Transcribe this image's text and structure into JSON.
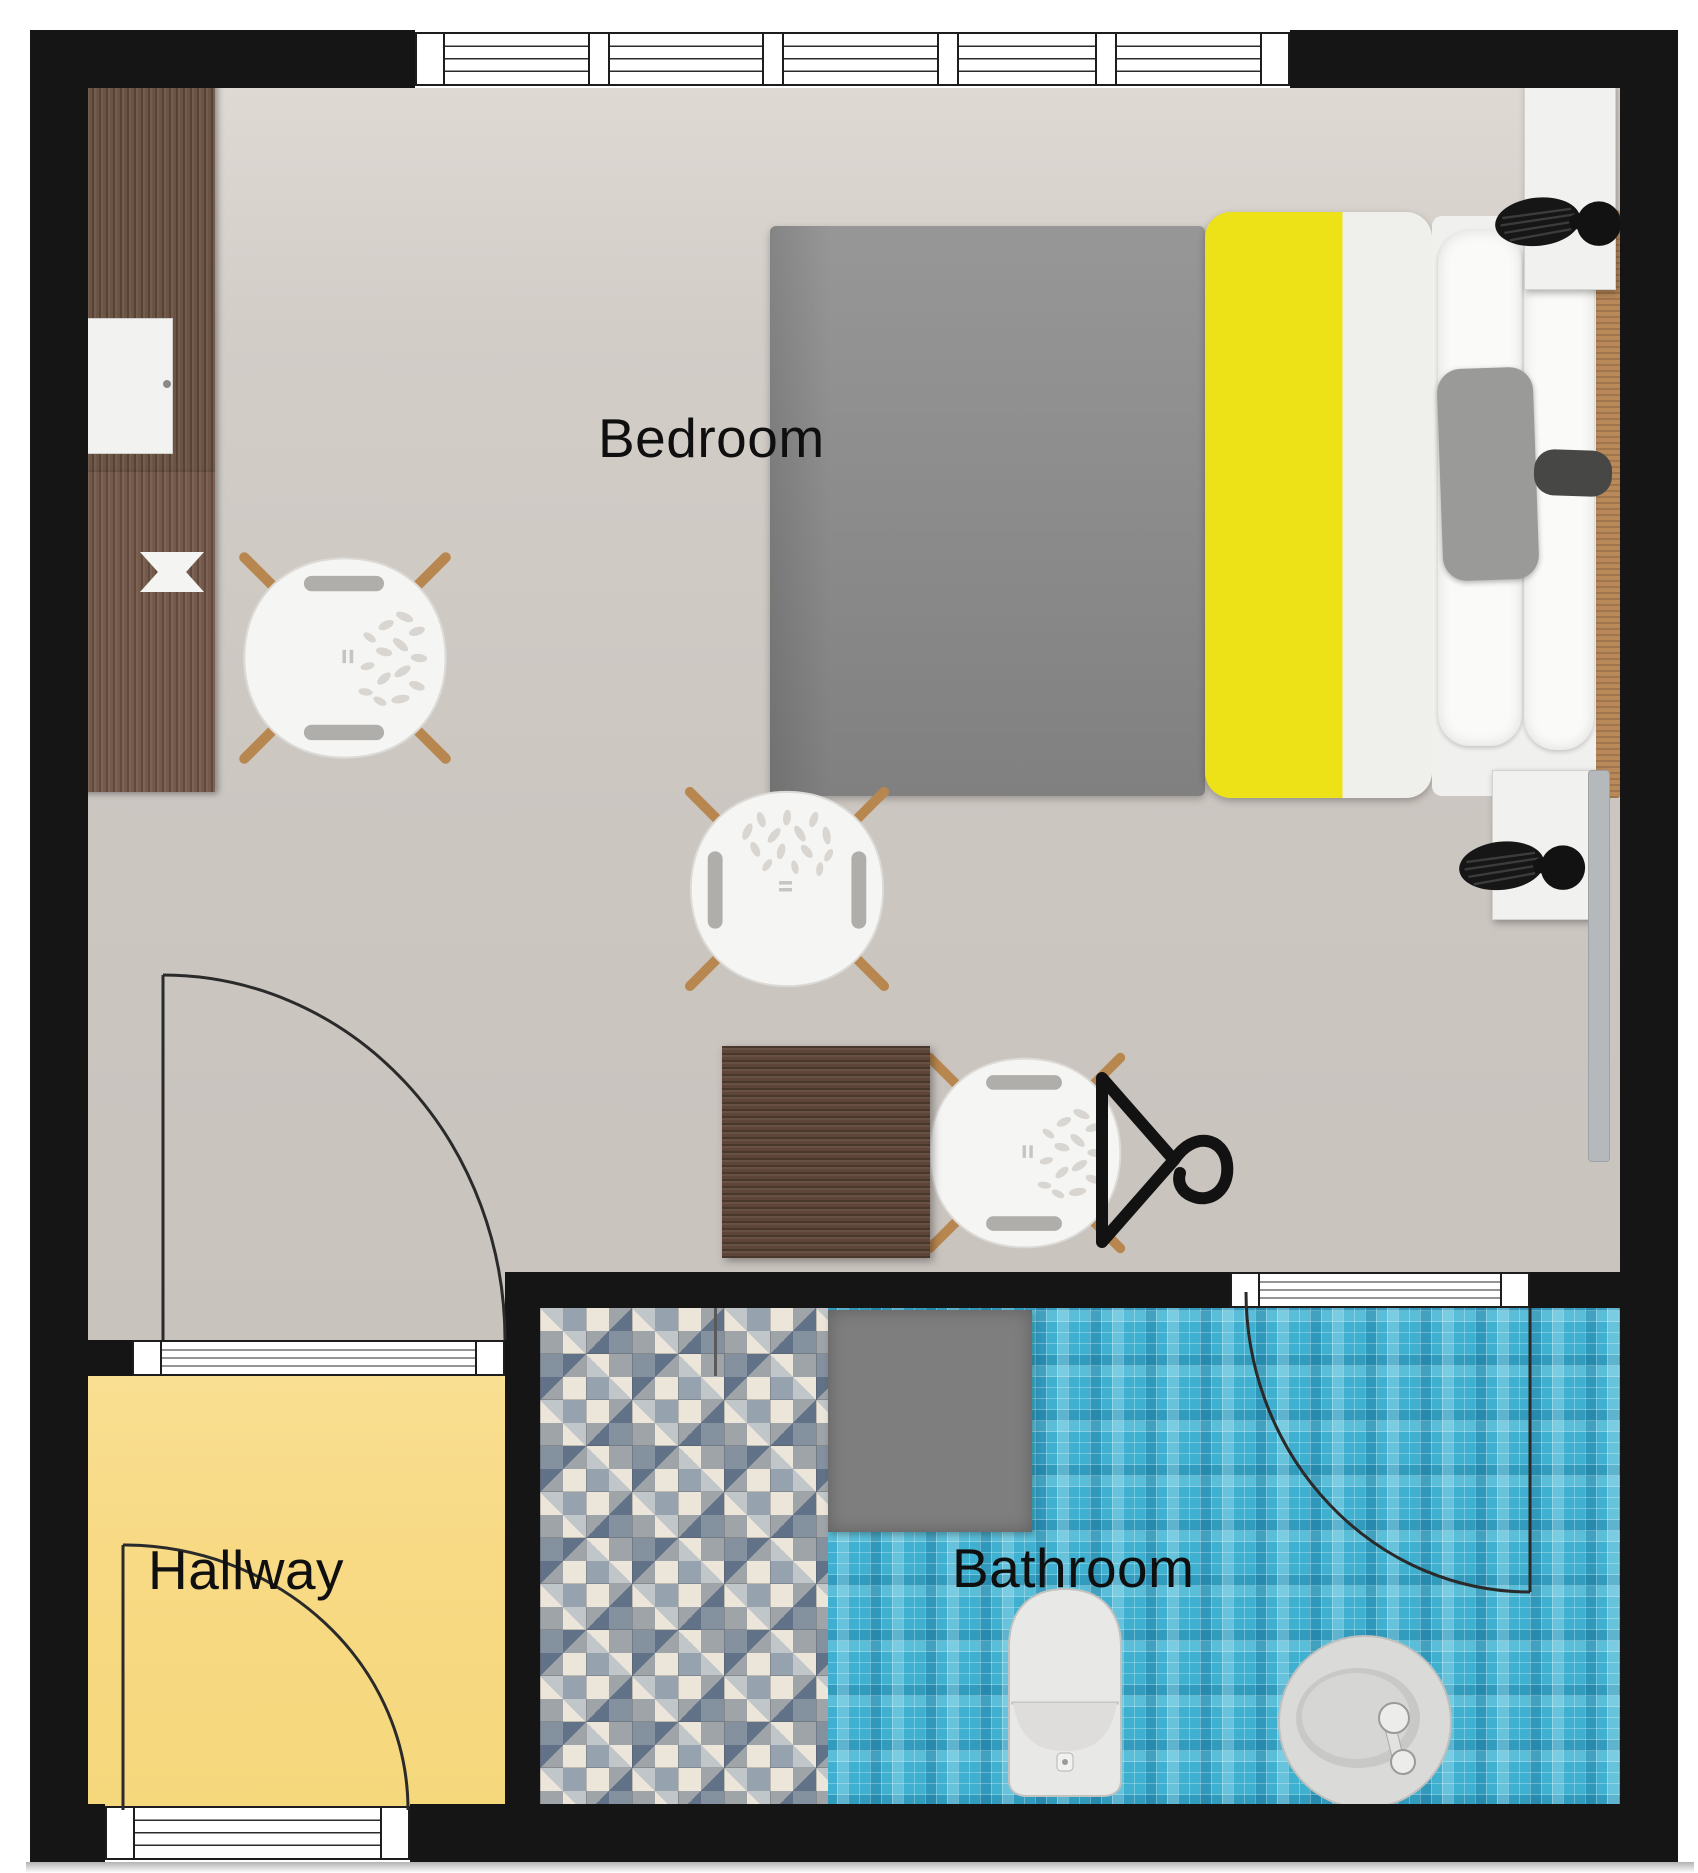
{
  "rooms": {
    "bedroom": {
      "label": "Bedroom"
    },
    "hallway": {
      "label": "Hallway"
    },
    "bathroom": {
      "label": "Bathroom"
    }
  },
  "colors": {
    "wall": "#151515",
    "bedroomFloor": "#cfc9c3",
    "hallwayFloor": "#f8da85",
    "bathroomTile": "#3fb0d0",
    "showerBase": "#d2ccbd",
    "duvetYellow": "#ece217",
    "blanketGray": "#8b8b8b",
    "woodDark": "#6b5444",
    "woodDesk": "#75594a",
    "woodLight": "#b9895a",
    "matGray": "#7e7e7e",
    "fixtureWhite": "#e9e9e7",
    "chairWhite": "#f5f5f3",
    "lampBlack": "#161616",
    "doorLine": "#2a2a2a",
    "labelColor": "#0f0f0f"
  },
  "icons": {
    "window": "striped-band",
    "door": "quarter-arc-with-leaf",
    "table-lamp": "black-leaf-fan",
    "clothes-hanger": "triangle-with-hook",
    "lounge-chair": "round-seat-wood-legs",
    "toilet": "rounded-tank-bowl",
    "sink": "round-basin-faucet",
    "shower": "patterned-tile-strip",
    "bath-mat": "gray-rectangle",
    "radiator": "gray-strip",
    "tv": "black-strip"
  }
}
